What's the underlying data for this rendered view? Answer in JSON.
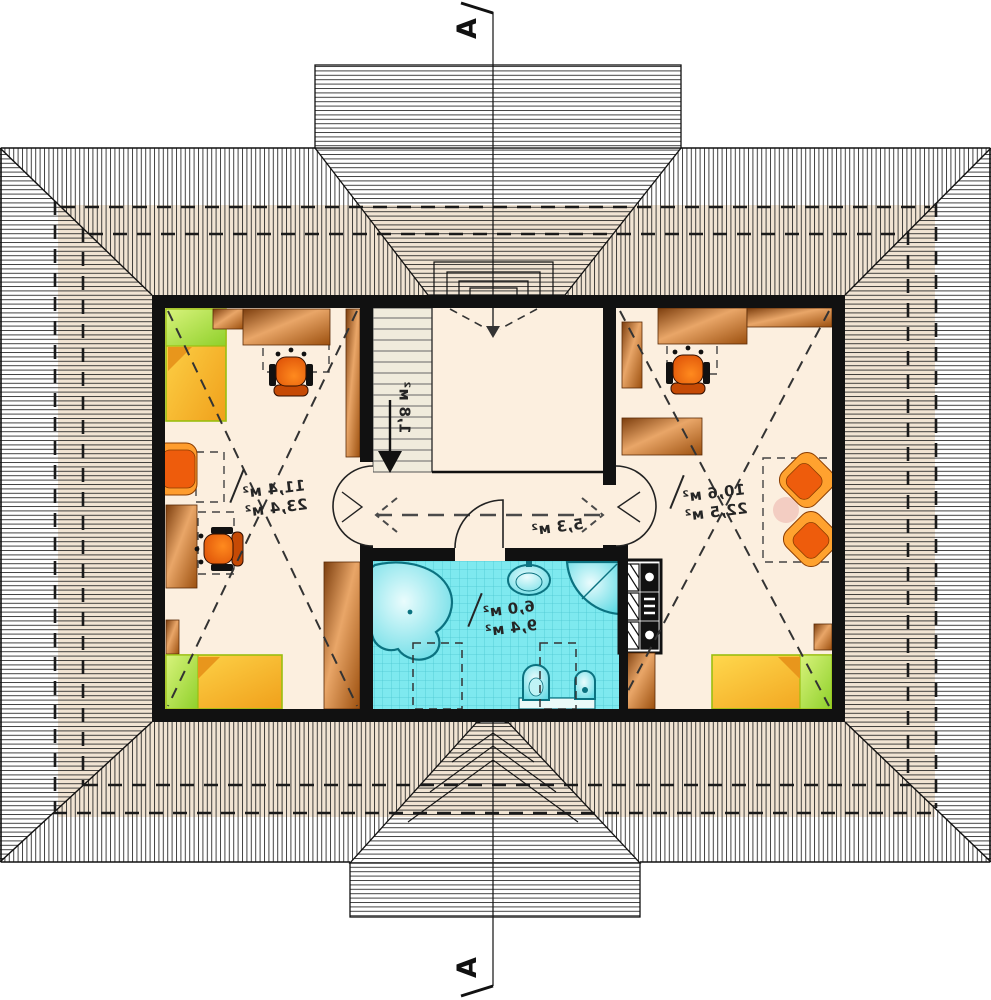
{
  "plan": {
    "type": "attic-floor-plan-mirrored",
    "section": {
      "label": "A"
    },
    "rooms": {
      "bedroom_left": {
        "name": "bedroom-left",
        "area_over": "11,4 м²",
        "area_floor": "23,4 м²"
      },
      "bedroom_right": {
        "name": "bedroom-right",
        "area_over": "10,6 м²",
        "area_floor": "22,5 м²"
      },
      "hall": {
        "name": "hall",
        "area": "5,3 м²"
      },
      "bathroom": {
        "name": "bathroom",
        "area_over": "6,0 м²",
        "area_floor": "9,4 м²"
      },
      "stairs": {
        "name": "stairs",
        "area": "1,8 м²"
      }
    },
    "colors": {
      "floor": "#fcefdf",
      "roof_tint": "#eedfcb",
      "wall": "#111111",
      "bath_tile": "#7ee9ef",
      "furniture_wood": "#c97a35",
      "chair_orange": "#ee5c0c",
      "bed_yellow": "#f7b524",
      "pillow_green": "#a5dd3c",
      "table_pink": "#f3cdc2"
    }
  }
}
